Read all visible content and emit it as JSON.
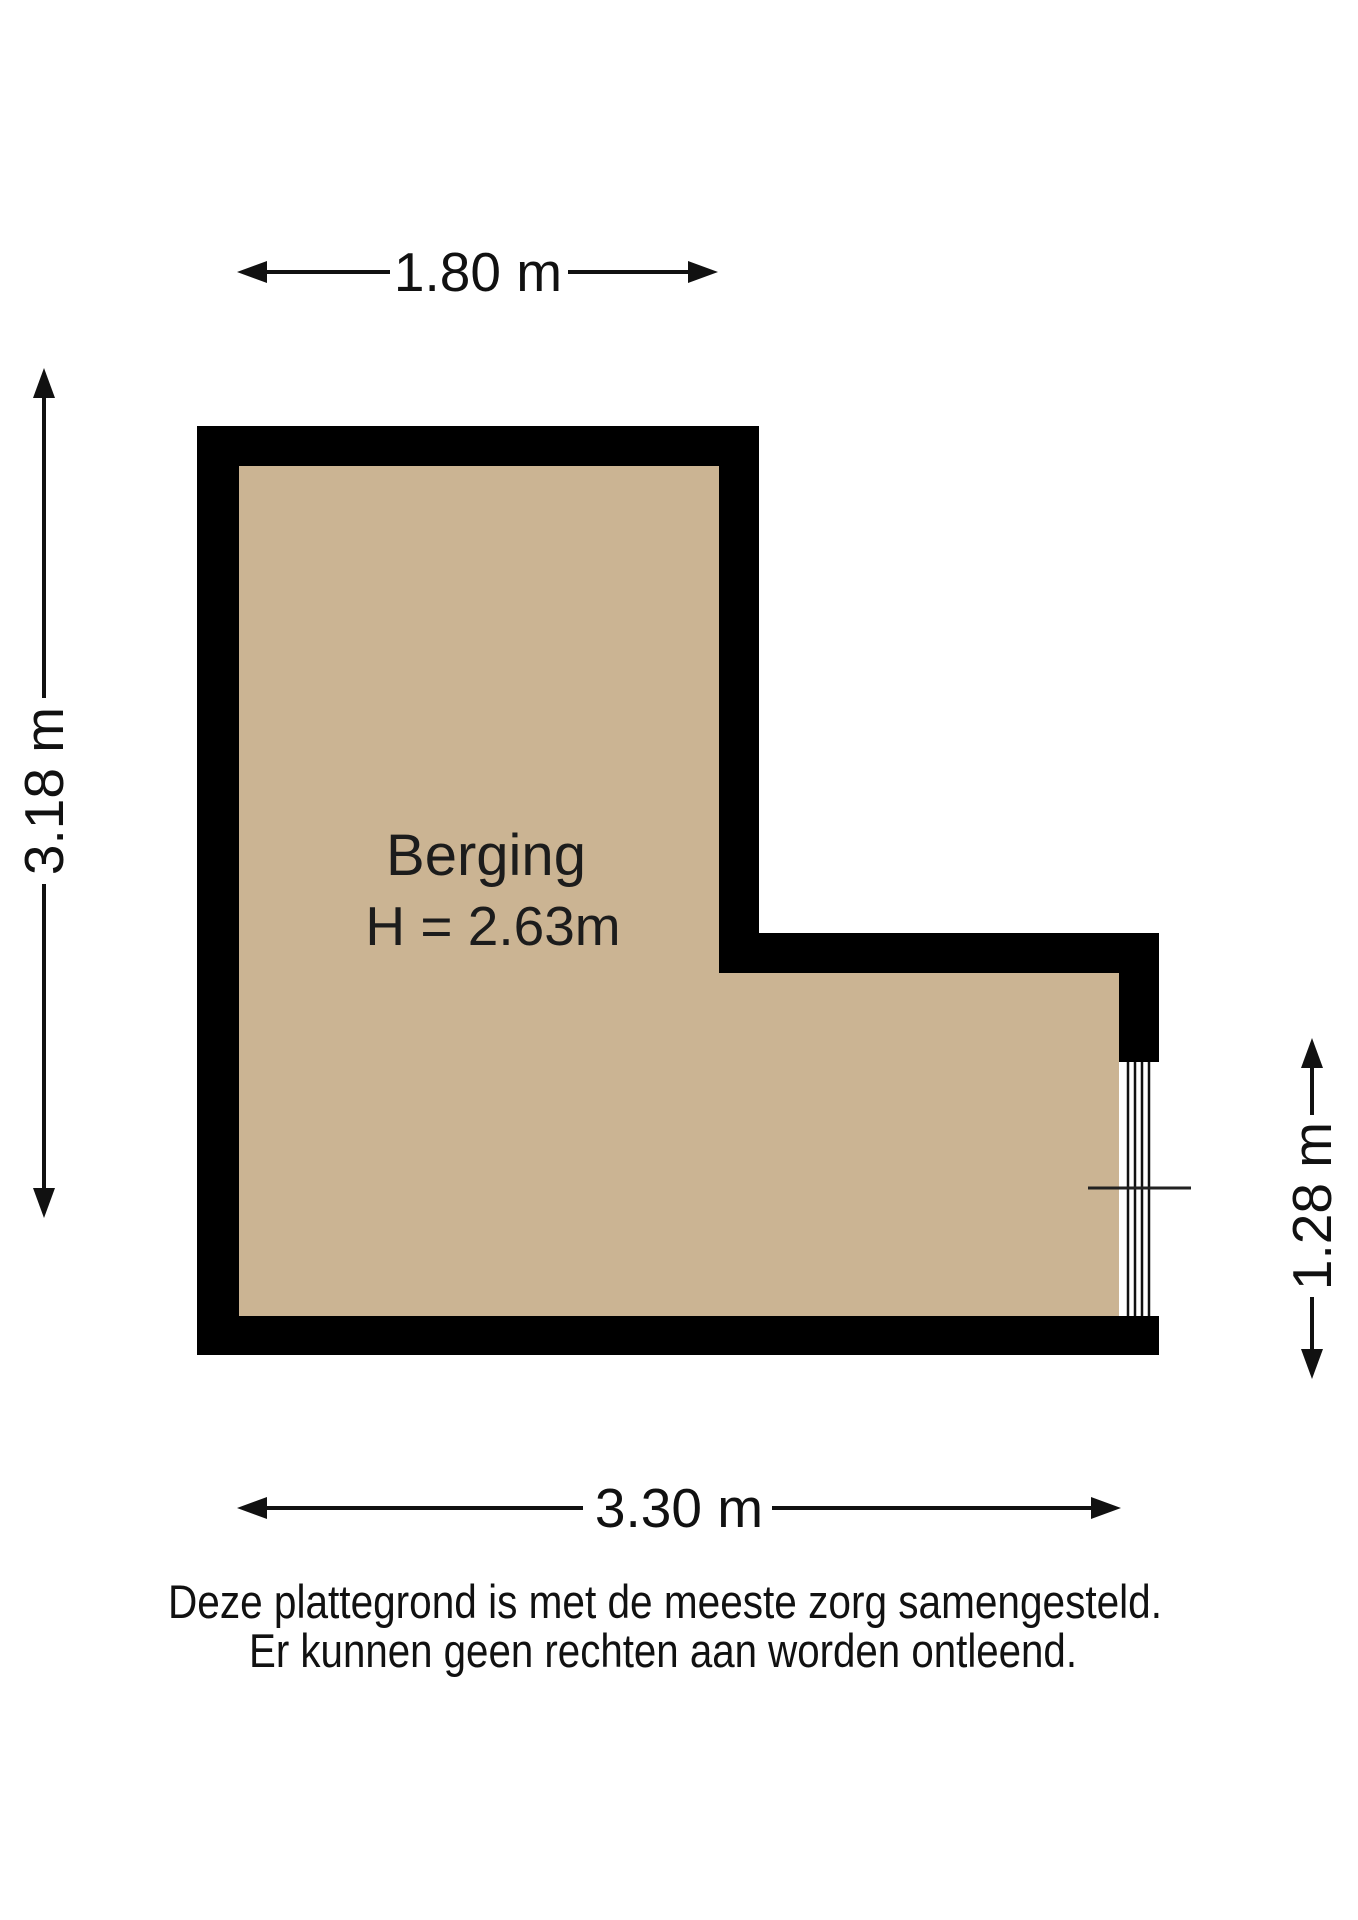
{
  "plan": {
    "room": {
      "name": "Berging",
      "ceiling_height": "H = 2.63m"
    },
    "dimensions": {
      "top": "1.80 m",
      "left": "3.18 m",
      "right": "1.28 m",
      "bottom": "3.30 m"
    }
  },
  "footer": {
    "disclaimer_line1": "Deze plattegrond is met de meeste zorg samengesteld.",
    "disclaimer_line2": "Er kunnen geen rechten aan worden ontleend."
  },
  "colors": {
    "floor": "#CBB493",
    "wall": "#000000",
    "text": "#111111",
    "background": "#FFFFFF"
  }
}
